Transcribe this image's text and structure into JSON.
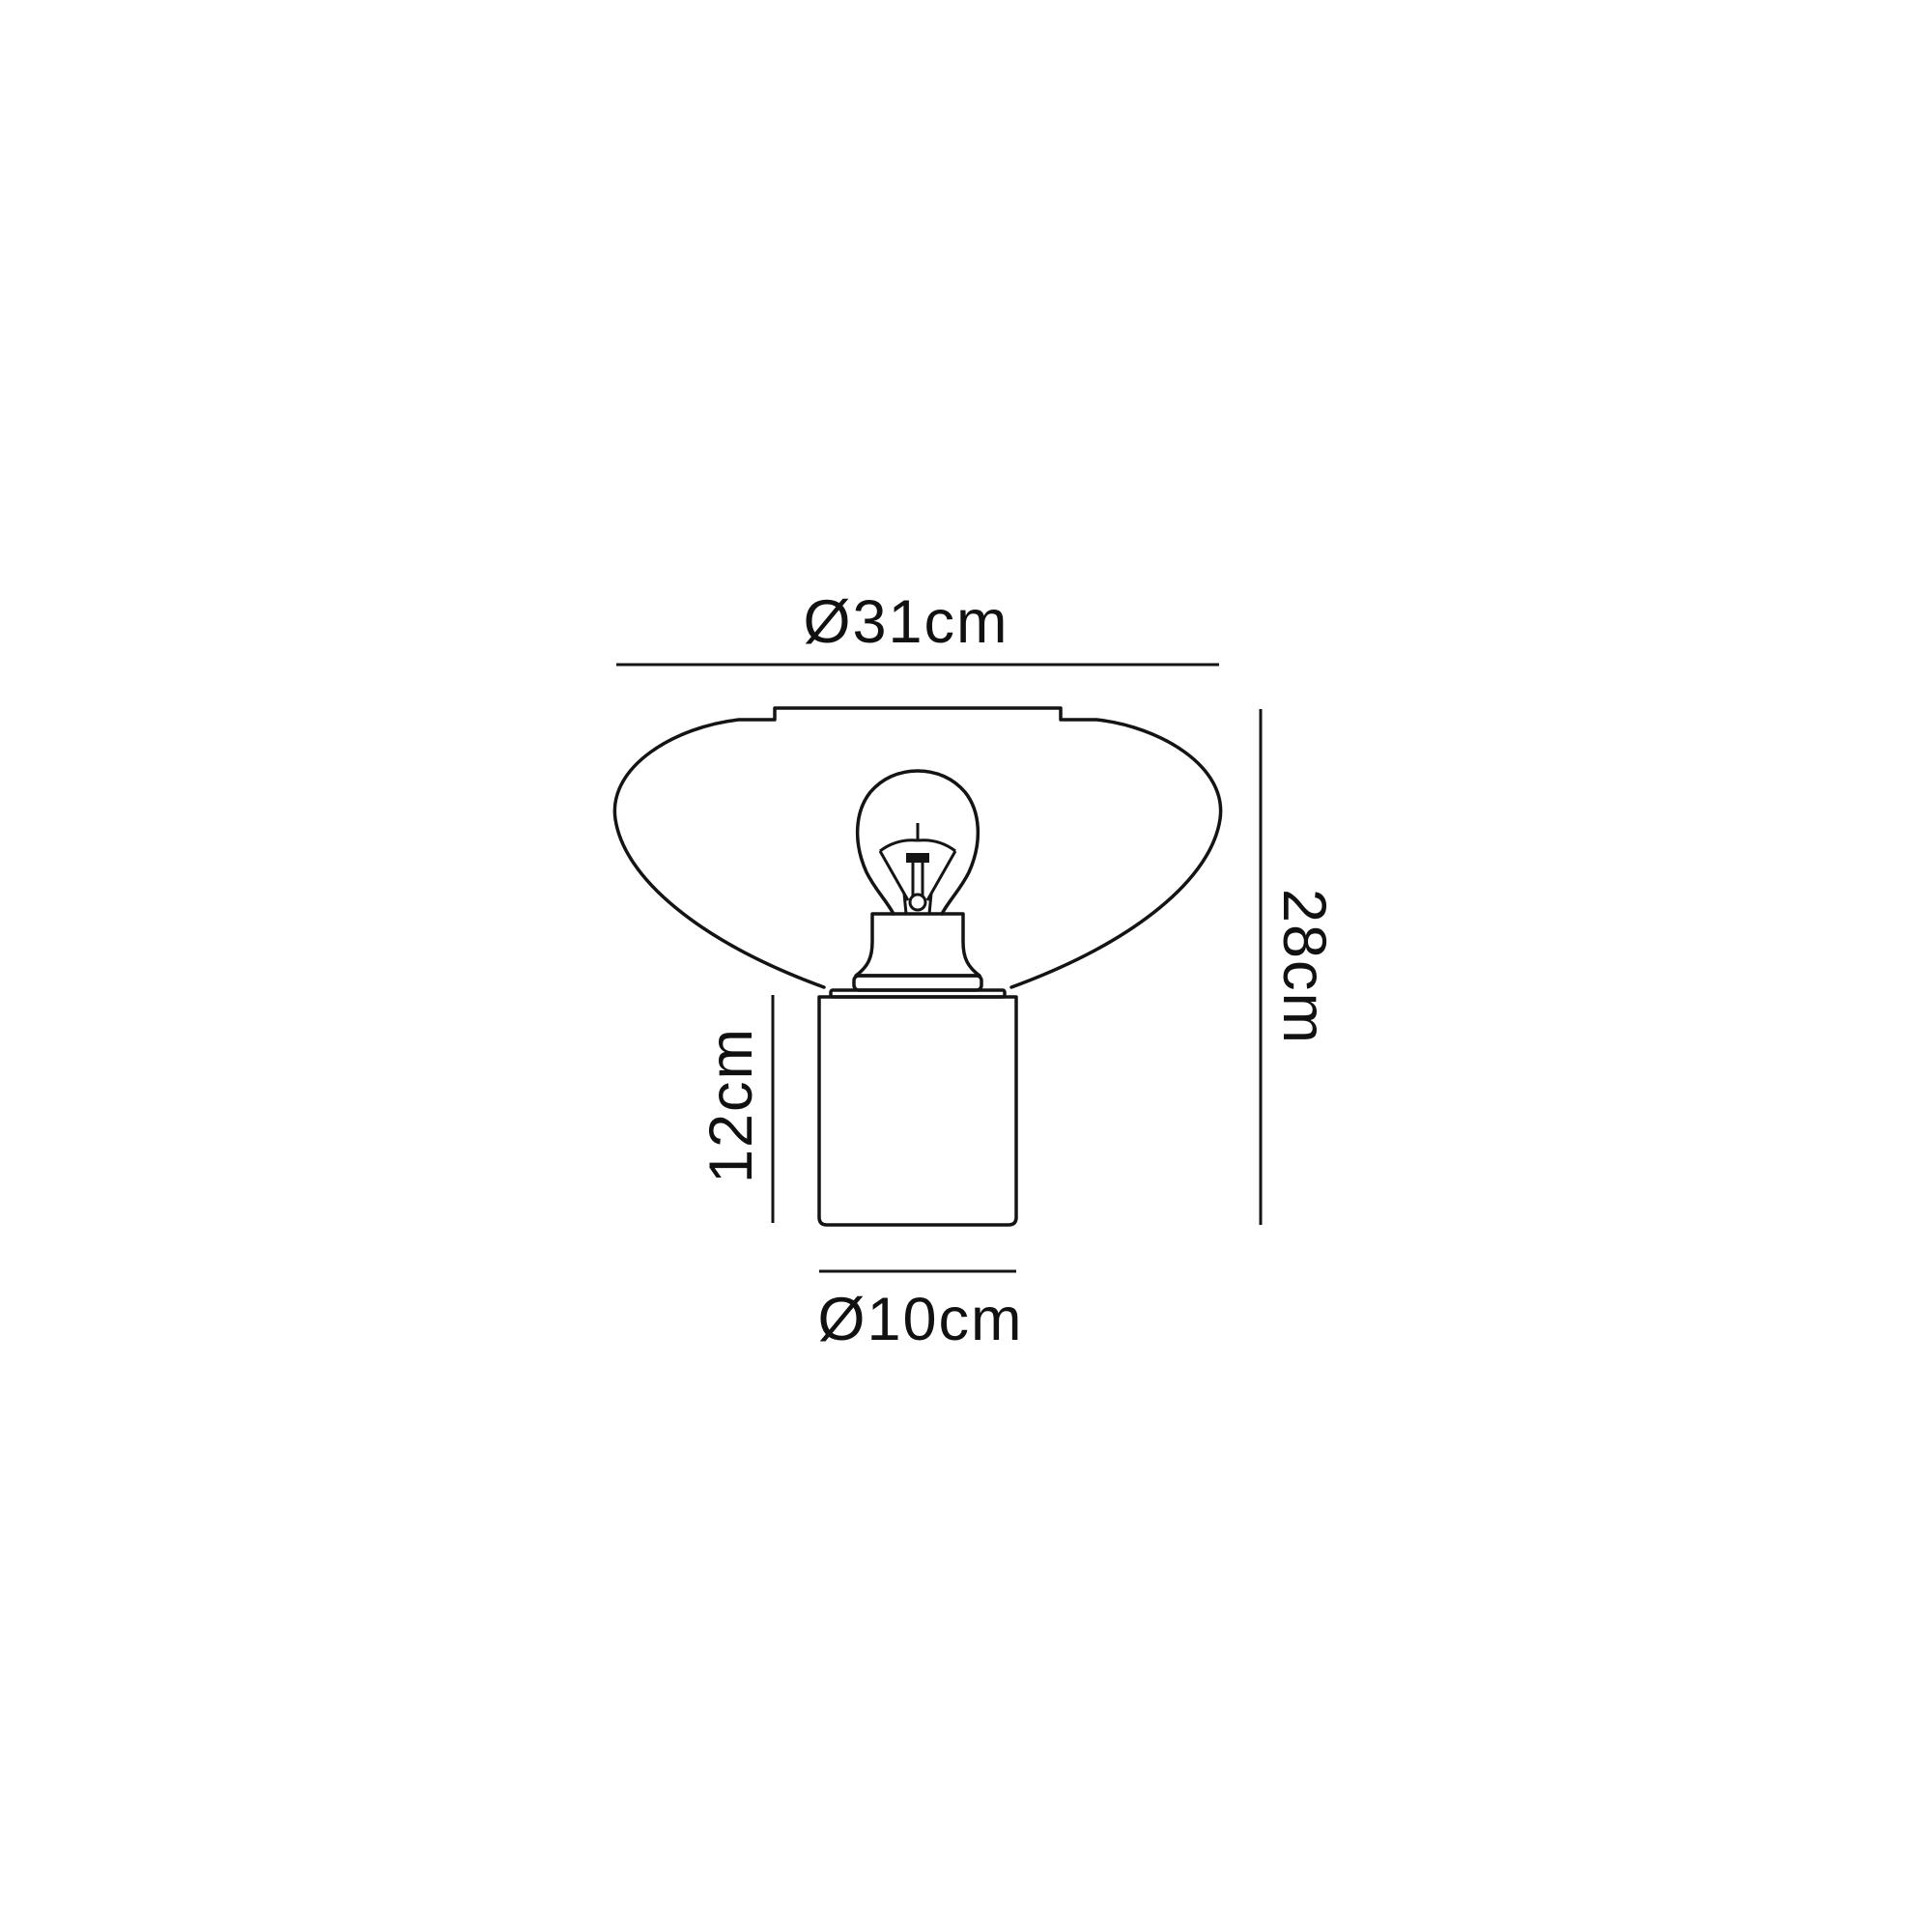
{
  "diagram": {
    "kind": "product-dimension-line-drawing",
    "subject": "table lamp with wide tapered shade, exposed bulb and cylindrical base",
    "background_color": "#ffffff",
    "line_color": "#141414",
    "text_color": "#111111",
    "dimensions": {
      "shade_diameter": "Ø31cm",
      "overall_height": "28cm",
      "base_height": "12cm",
      "base_diameter": "Ø10cm"
    }
  }
}
